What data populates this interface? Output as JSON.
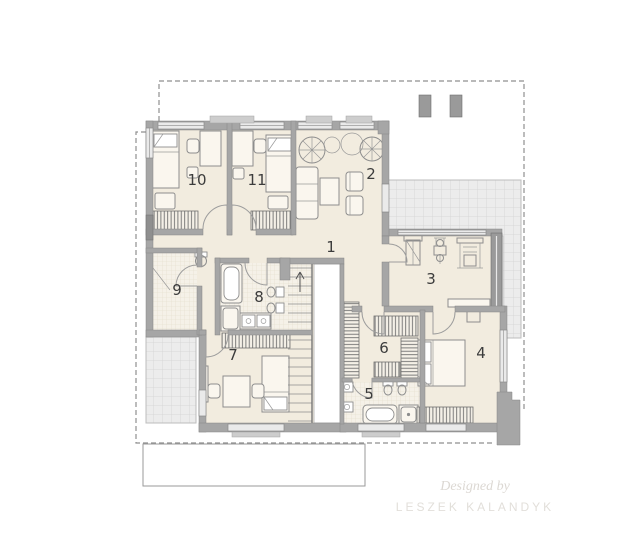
{
  "plan": {
    "type": "floor-plan",
    "rooms": [
      {
        "number": "1"
      },
      {
        "number": "2"
      },
      {
        "number": "3"
      },
      {
        "number": "4"
      },
      {
        "number": "5"
      },
      {
        "number": "6"
      },
      {
        "number": "7"
      },
      {
        "number": "8"
      },
      {
        "number": "9"
      },
      {
        "number": "10"
      },
      {
        "number": "11"
      }
    ]
  },
  "watermark": {
    "line1": "Designed by",
    "line2": "LESZEK KALANDYK"
  },
  "colors": {
    "background": "#ffffff",
    "floor": "#f2ecdf",
    "wall": "#a6a6a6",
    "terrace_tile": "#ececec",
    "terrace_grid": "#d7d7d7",
    "bath_tile": "#f6f2ea",
    "dashed_outline": "#8f8f8f",
    "room_label": "#3c3c3c",
    "watermark": "#dcd8d3"
  }
}
